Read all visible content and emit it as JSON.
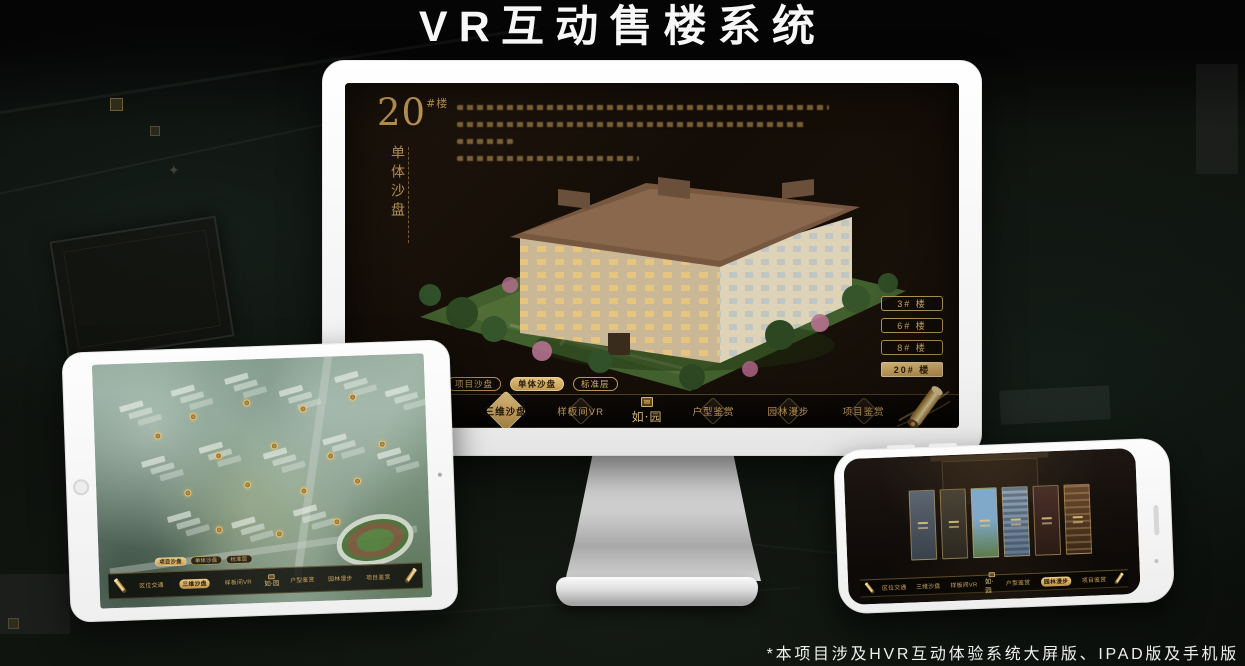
{
  "page": {
    "title": "VR互动售楼系统",
    "footnote": "*本项目涉及HVR互动体验系统大屏版、IPAD版及手机版"
  },
  "brand": {
    "logo_text": "如·园"
  },
  "menu": {
    "items": [
      {
        "label": "区位交通"
      },
      {
        "label": "三维沙盘"
      },
      {
        "label": "样板间VR"
      },
      {
        "label": "户型鉴赏"
      },
      {
        "label": "园林漫步"
      },
      {
        "label": "项目鉴赏"
      }
    ]
  },
  "subtabs": {
    "items": [
      {
        "label": "项目沙盘"
      },
      {
        "label": "单体沙盘"
      },
      {
        "label": "标准层"
      }
    ]
  },
  "desktop": {
    "heading_number": "20",
    "heading_suffix": "#楼",
    "heading_vertical": "单体沙盘",
    "floor_buttons": [
      {
        "label": "3# 楼",
        "active": false
      },
      {
        "label": "6# 楼",
        "active": false
      },
      {
        "label": "8# 楼",
        "active": false
      },
      {
        "label": "20# 楼",
        "active": true
      }
    ],
    "active_subtab": "单体沙盘",
    "active_nav_item": "三维沙盘"
  },
  "tablet": {
    "active_subtab": "项目沙盘",
    "active_nav_item": "三维沙盘"
  },
  "phone": {
    "active_nav_item": "园林漫步"
  },
  "colors": {
    "gold": "#c9a25f",
    "gold_bright": "#ecca84",
    "screen_bg": "#17100a",
    "nav_bg": "#0a0704",
    "active_text": "#2a1d0c"
  }
}
